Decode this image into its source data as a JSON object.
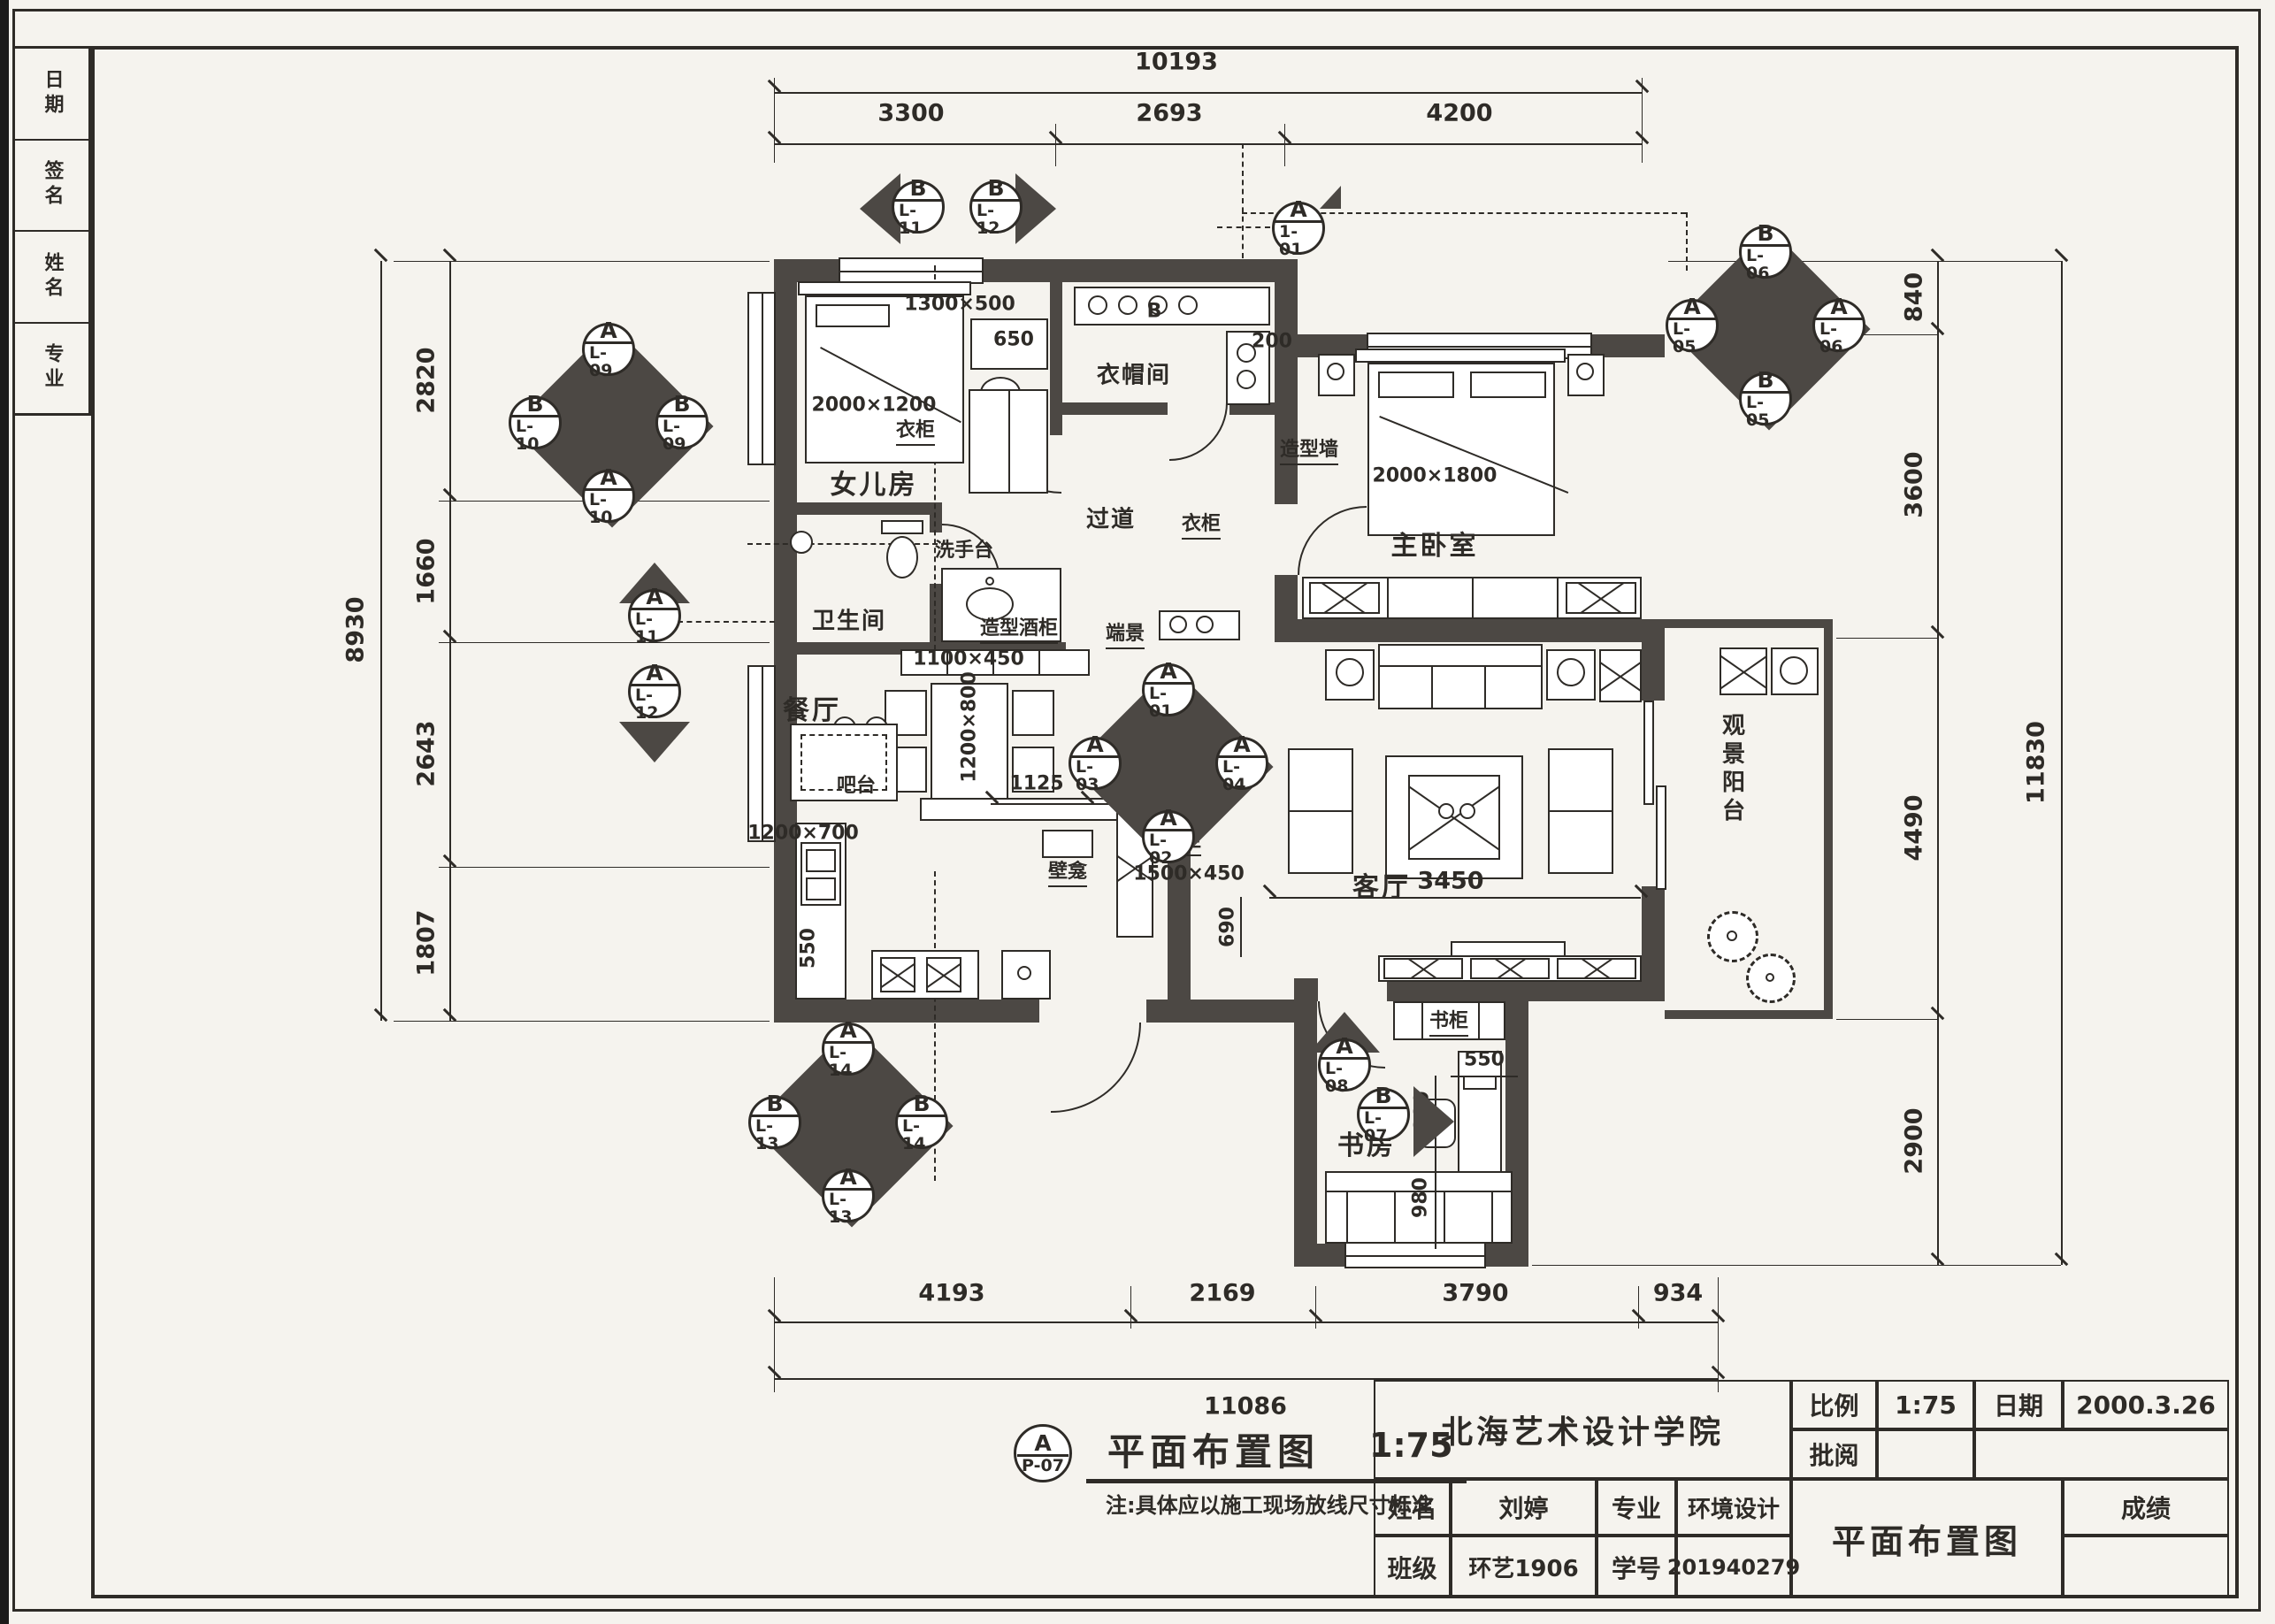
{
  "sheet": {
    "paper": "#f5f3ee",
    "ink": "#2e2b27",
    "wall": "#4c4844"
  },
  "margin_strip": {
    "rows": [
      "日期",
      "签名",
      "姓名",
      "专业"
    ]
  },
  "title_block": {
    "school": "北海艺术设计学院",
    "scale_label": "比例",
    "scale_value": "1:75",
    "date_label": "日期",
    "date_value": "2000.3.26",
    "review_label": "批阅",
    "name_label": "姓名",
    "name_value": "刘婷",
    "major_label": "专业",
    "major_value": "环境设计",
    "class_label": "班级",
    "class_value": "环艺1906",
    "student_id_label": "学号",
    "student_id_value": "201940279",
    "drawing_title": "平面布置图",
    "grade_label": "成绩"
  },
  "legend": {
    "marker_top": "A",
    "marker_bottom": "P-07",
    "title": "平面布置图",
    "scale": "1:75",
    "note": "注:具体应以施工现场放线尺寸标准"
  },
  "dims": {
    "top": {
      "total": "10193",
      "segs": [
        "3300",
        "2693",
        "4200"
      ]
    },
    "bottom": {
      "total": "11086",
      "segs": [
        "4193",
        "2169",
        "3790",
        "934"
      ]
    },
    "left": {
      "total": "8930",
      "segs": [
        "2820",
        "1660",
        "2643",
        "1807"
      ]
    },
    "right": {
      "total": "11830",
      "segs": [
        "840",
        "3600",
        "4490",
        "2900"
      ]
    }
  },
  "rooms": {
    "girl": "女儿房",
    "cloak": "衣帽间",
    "master": "主卧室",
    "corridor": "过道",
    "bath": "卫生间",
    "dining": "餐厅",
    "living": "客厅",
    "study": "书房",
    "balcony": "观景阳台"
  },
  "labels": {
    "girl_bed_size": "2000×1200",
    "girl_desk_size": "1300×500",
    "wardrobe": "衣柜",
    "wardrobe2": "衣柜",
    "washstand": "洗手台",
    "washstand_size": "1100×450",
    "master_bed_size": "2000×1800",
    "feature_wall": "造型墙",
    "end_view": "端景",
    "wine_cabinet": "造型酒柜",
    "bar": "吧台",
    "bar_size": "1200×700",
    "dining_table_size": "1200×800",
    "niche": "壁龛",
    "shoe_cabinet": "鞋柜",
    "shoe_cabinet_size": "1500×450",
    "bookcase": "书柜",
    "letter_b": "B"
  },
  "inner_dims": {
    "d650": "650",
    "d200": "200",
    "d1125": "1125",
    "d240": "240",
    "d3450": "3450",
    "d690": "690",
    "d550_study": "550",
    "d1880": "1880",
    "d980": "980",
    "d550_kitchen": "550"
  },
  "markers": {
    "pair_top": {
      "left": {
        "t": "B",
        "b": "L-11"
      },
      "right": {
        "t": "B",
        "b": "L-12"
      }
    },
    "cluster_left": {
      "up": {
        "t": "A",
        "b": "L-09"
      },
      "left": {
        "t": "B",
        "b": "L-10"
      },
      "right": {
        "t": "B",
        "b": "L-09"
      },
      "down": {
        "t": "A",
        "b": "L-10"
      }
    },
    "pair_left": {
      "up": {
        "t": "A",
        "b": "L-11"
      },
      "down": {
        "t": "A",
        "b": "L-12"
      }
    },
    "cluster_right": {
      "up": {
        "t": "B",
        "b": "L-06"
      },
      "left": {
        "t": "A",
        "b": "L-05"
      },
      "right": {
        "t": "A",
        "b": "L-06"
      },
      "down": {
        "t": "B",
        "b": "L-05"
      }
    },
    "cluster_living": {
      "up": {
        "t": "A",
        "b": "L-01"
      },
      "left": {
        "t": "A",
        "b": "L-03"
      },
      "right": {
        "t": "A",
        "b": "L-04"
      },
      "down": {
        "t": "A",
        "b": "L-02"
      }
    },
    "cluster_bottom": {
      "up": {
        "t": "A",
        "b": "L-14"
      },
      "left": {
        "t": "B",
        "b": "L-13"
      },
      "right": {
        "t": "B",
        "b": "L-14"
      },
      "down": {
        "t": "A",
        "b": "L-13"
      }
    },
    "study_a": {
      "t": "A",
      "b": "L-08"
    },
    "study_b": {
      "t": "B",
      "b": "L-07"
    },
    "section_top": {
      "t": "A",
      "b": "1-01"
    }
  }
}
